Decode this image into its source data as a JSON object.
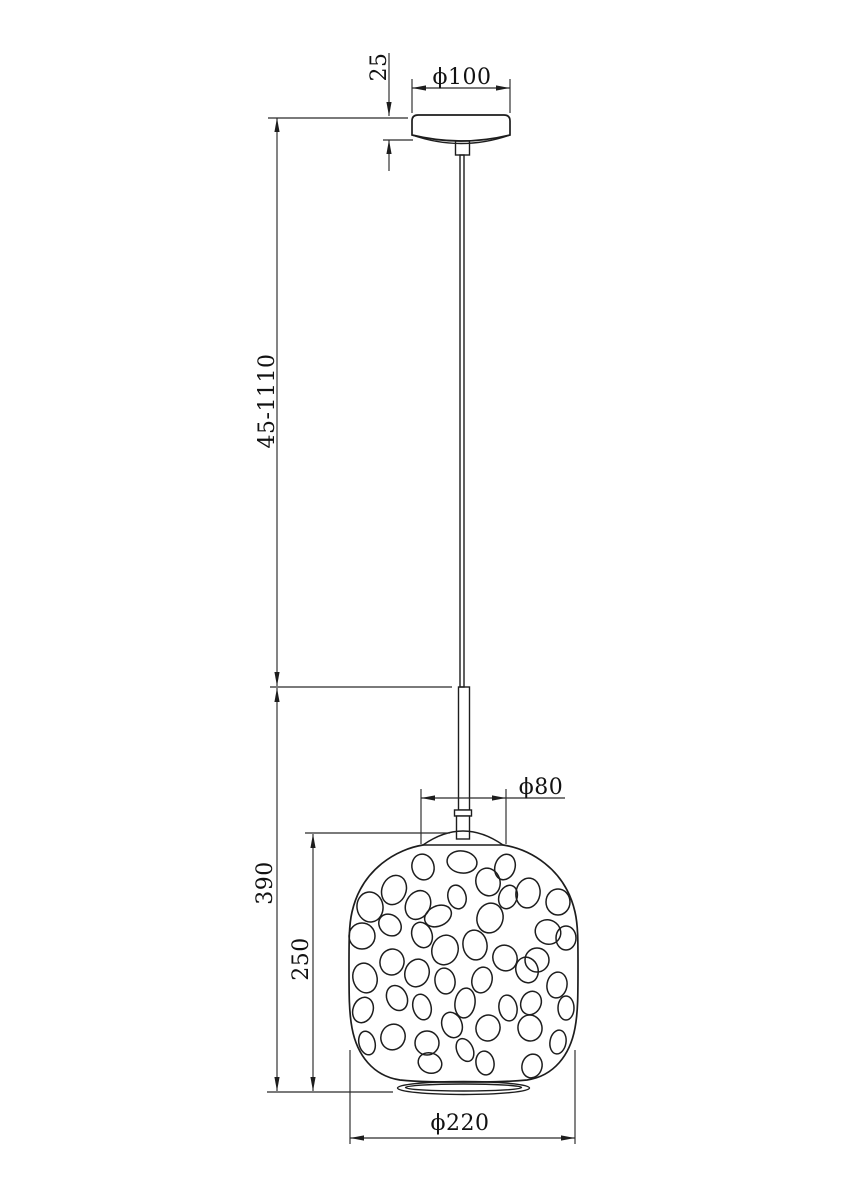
{
  "drawing": {
    "kind": "technical-dimension-drawing",
    "subject": "pendant lamp with perforated pebble-pattern shade",
    "background_color": "#ffffff",
    "line_color": "#1d1d1d",
    "labels": {
      "canopy_height": "25",
      "canopy_diameter": "ϕ100",
      "suspension_length": "45-1110",
      "fixture_drop": "390",
      "shade_height": "250",
      "shade_top_diameter": "ϕ80",
      "shade_diameter": "ϕ220"
    },
    "pebbles": [
      [
        423,
        867,
        11,
        13,
        -15
      ],
      [
        462,
        862,
        15,
        11,
        8
      ],
      [
        505,
        867,
        10,
        13,
        18
      ],
      [
        394,
        890,
        12,
        15,
        22
      ],
      [
        488,
        882,
        12,
        14,
        -18
      ],
      [
        528,
        893,
        12,
        15,
        10
      ],
      [
        370,
        907,
        13,
        15,
        -8
      ],
      [
        418,
        905,
        12,
        15,
        28
      ],
      [
        457,
        897,
        9,
        12,
        -15
      ],
      [
        508,
        897,
        9,
        12,
        20
      ],
      [
        558,
        902,
        12,
        13,
        0
      ],
      [
        438,
        916,
        14,
        10,
        -25
      ],
      [
        490,
        918,
        13,
        15,
        15
      ],
      [
        390,
        925,
        12,
        10,
        40
      ],
      [
        362,
        936,
        13,
        13,
        0
      ],
      [
        422,
        935,
        10,
        13,
        -20
      ],
      [
        548,
        932,
        13,
        12,
        30
      ],
      [
        475,
        945,
        12,
        15,
        -10
      ],
      [
        445,
        950,
        13,
        15,
        20
      ],
      [
        566,
        938,
        10,
        12,
        0
      ],
      [
        505,
        958,
        12,
        13,
        -25
      ],
      [
        392,
        962,
        12,
        13,
        15
      ],
      [
        537,
        960,
        12,
        12,
        0
      ],
      [
        365,
        978,
        12,
        15,
        -15
      ],
      [
        417,
        973,
        12,
        14,
        20
      ],
      [
        445,
        981,
        10,
        13,
        -10
      ],
      [
        482,
        980,
        10,
        13,
        15
      ],
      [
        527,
        970,
        11,
        13,
        -20
      ],
      [
        557,
        985,
        10,
        13,
        10
      ],
      [
        397,
        998,
        10,
        13,
        -25
      ],
      [
        465,
        1003,
        10,
        15,
        8
      ],
      [
        422,
        1007,
        9,
        13,
        -15
      ],
      [
        363,
        1010,
        10,
        13,
        20
      ],
      [
        508,
        1008,
        9,
        13,
        -10
      ],
      [
        531,
        1003,
        10,
        12,
        25
      ],
      [
        566,
        1008,
        8,
        12,
        0
      ],
      [
        452,
        1025,
        10,
        13,
        -20
      ],
      [
        488,
        1028,
        12,
        13,
        15
      ],
      [
        530,
        1028,
        12,
        13,
        -10
      ],
      [
        393,
        1037,
        12,
        13,
        25
      ],
      [
        367,
        1043,
        8,
        12,
        -15
      ],
      [
        427,
        1043,
        12,
        12,
        0
      ],
      [
        558,
        1042,
        8,
        12,
        10
      ],
      [
        465,
        1050,
        8,
        12,
        -25
      ],
      [
        430,
        1063,
        12,
        10,
        20
      ],
      [
        485,
        1063,
        9,
        12,
        -10
      ],
      [
        532,
        1066,
        10,
        12,
        15
      ]
    ]
  }
}
